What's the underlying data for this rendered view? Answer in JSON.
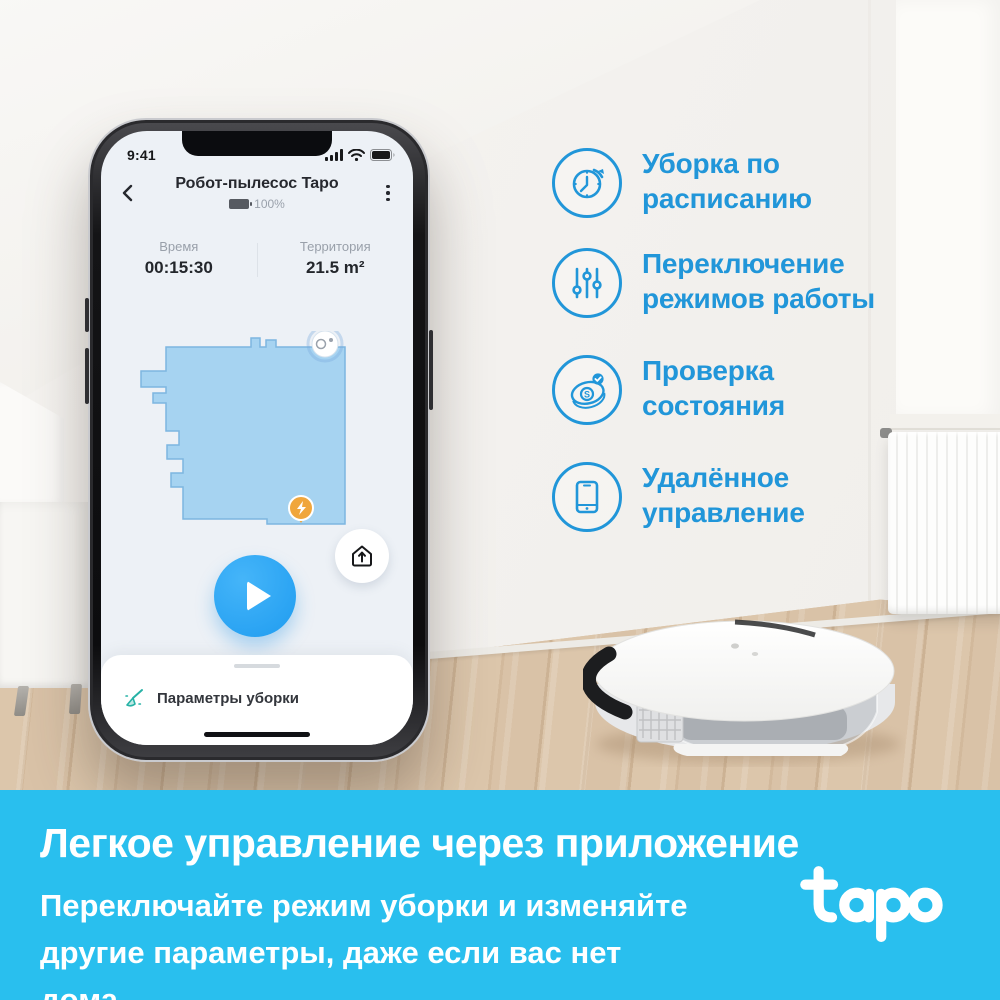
{
  "phone": {
    "status_bar": {
      "time": "9:41"
    },
    "header": {
      "title": "Робот-пылесос Tapo",
      "battery_percent": "100%"
    },
    "stats": [
      {
        "label": "Время",
        "value": "00:15:30"
      },
      {
        "label": "Территория",
        "value": "21.5 m²"
      }
    ],
    "bottom_sheet": {
      "label": "Параметры уборки"
    }
  },
  "features": [
    {
      "label": "Уборка по расписанию",
      "icon": "schedule-clock-icon"
    },
    {
      "label": "Переключение режимов работы",
      "icon": "mode-sliders-icon"
    },
    {
      "label": "Проверка состояния",
      "icon": "status-check-icon"
    },
    {
      "label": "Удалённое управление",
      "icon": "remote-phone-icon"
    }
  ],
  "banner": {
    "title": "Легкое управление через приложение",
    "subtitle": "Переключайте режим уборки и изменяйте другие параметры, даже если вас нет дома.",
    "brand": "tapo",
    "background_color": "#29bfee",
    "text_color": "#ffffff"
  },
  "colors": {
    "accent_blue": "#2196d9",
    "map_fill": "#a6d3f1",
    "play_button_blue": "#2ba7f4",
    "dock_marker_orange": "#f0a63c",
    "broom_teal": "#27b2a6"
  }
}
